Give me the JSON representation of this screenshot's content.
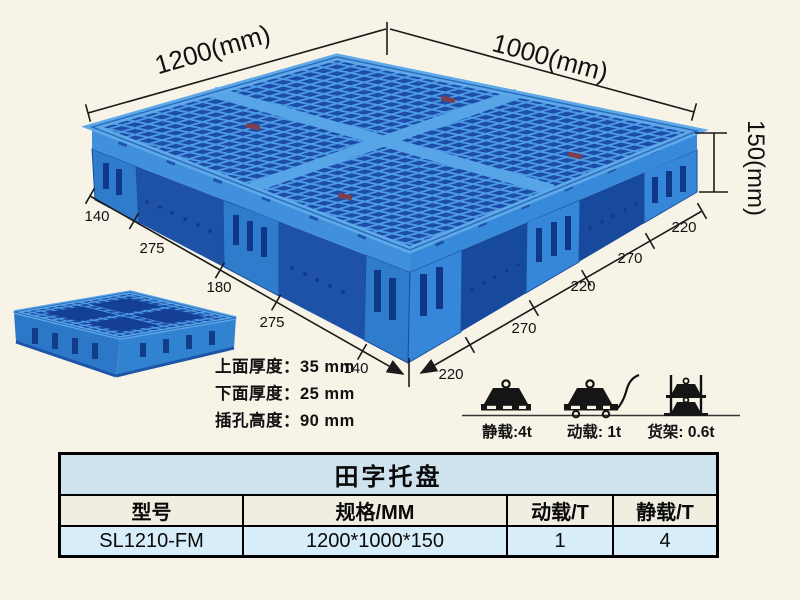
{
  "colors": {
    "background": "#f7f4e7",
    "pallet_blue": "#3584d8",
    "pallet_light_rib": "#5fa8e8",
    "pallet_dark_hole": "#1d4da9",
    "dimension_line": "#1a1a1a",
    "table_title_bg": "#cfe3ef",
    "table_header_bg": "#f1eee1",
    "table_row_bg": "#d7edf9"
  },
  "dimensions": {
    "top_left": "1200(mm)",
    "top_right": "1000(mm)",
    "height": "150(mm)",
    "left_edge": [
      "140",
      "275",
      "180",
      "275",
      "140"
    ],
    "right_edge": [
      "220",
      "270",
      "220",
      "270",
      "220"
    ]
  },
  "specs": {
    "top_thickness": "上面厚度：35 mm",
    "bottom_thickness": "下面厚度：25 mm",
    "fork_height": "插孔高度：90 mm"
  },
  "load_icons": [
    {
      "name": "static-load",
      "label": "静载:4t"
    },
    {
      "name": "dynamic-load",
      "label": "动载: 1t"
    },
    {
      "name": "rack-load",
      "label": "货架: 0.6t"
    }
  ],
  "table": {
    "title": "田字托盘",
    "headers": [
      "型号",
      "规格/MM",
      "动载/T",
      "静载/T"
    ],
    "rows": [
      [
        "SL1210-FM",
        "1200*1000*150",
        "1",
        "4"
      ]
    ]
  }
}
